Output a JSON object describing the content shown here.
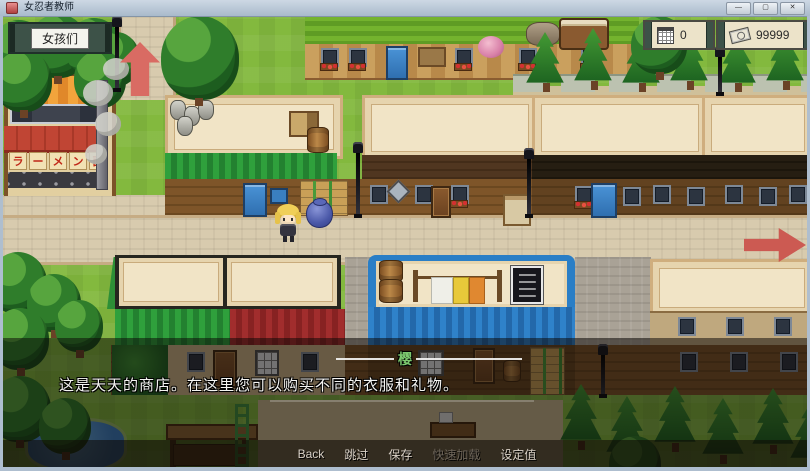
{
  "window": {
    "title": "女忍者教师",
    "minimize_label": "—",
    "maximize_label": "▢",
    "close_label": "✕"
  },
  "hud": {
    "girls_button_label": "女孩们",
    "day_counter": {
      "icon": "calendar-icon",
      "value": "0"
    },
    "money_counter": {
      "icon": "banknote-icon",
      "value": "99999"
    }
  },
  "map": {
    "ramen_sign_chars": [
      "ラ",
      "ー",
      "メ",
      "ン",
      "面"
    ],
    "exit_arrows": [
      "up",
      "right"
    ]
  },
  "dialogue": {
    "speaker_name": "樱",
    "text": "这是天天的商店。在这里您可以购买不同的衣服和礼物。"
  },
  "menu_bar": {
    "items": [
      {
        "label": "Back",
        "enabled": true
      },
      {
        "label": "跳过",
        "enabled": true
      },
      {
        "label": "保存",
        "enabled": true
      },
      {
        "label": "快速加载",
        "enabled": false
      },
      {
        "label": "设定值",
        "enabled": true
      }
    ]
  },
  "colors": {
    "grass": "#83b93e",
    "street": "#d8cbae",
    "roof_cream": "#f1e4c6",
    "awning_green": "#2fa03c",
    "awning_red": "#a12d2d",
    "awning_blue": "#2f82ca",
    "arrow_red": "#cc5a52",
    "speaker_name_green": "#7cc86e"
  }
}
